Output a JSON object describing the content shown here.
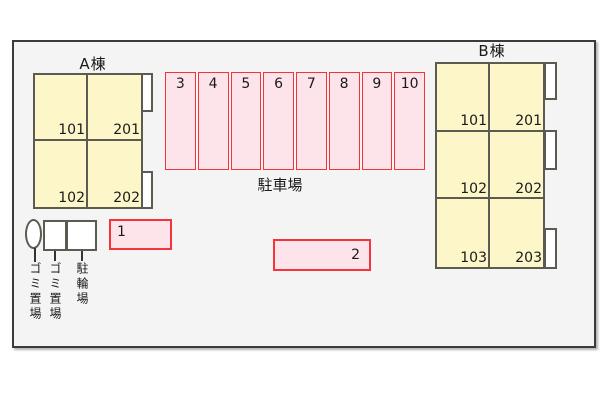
{
  "buildings": {
    "a": {
      "label": "A棟",
      "units": [
        [
          "101",
          "201"
        ],
        [
          "102",
          "202"
        ]
      ]
    },
    "b": {
      "label": "B棟",
      "units": [
        [
          "101",
          "201"
        ],
        [
          "102",
          "202"
        ],
        [
          "103",
          "203"
        ]
      ]
    }
  },
  "parking": {
    "label": "駐車場",
    "stalls": [
      "3",
      "4",
      "5",
      "6",
      "7",
      "8",
      "9",
      "10"
    ],
    "standalone_stalls": [
      "1",
      "2"
    ]
  },
  "facilities": {
    "garbage_area_1": "ゴミ置場",
    "garbage_area_2": "ゴミ置場",
    "bicycle_parking": "駐輪場"
  },
  "colors": {
    "building_fill": "#FCF6C8",
    "building_border": "#5B5B51",
    "parking_fill": "#FDE3EA",
    "parking_border": "#F5333B",
    "canvas_bg": "#F4F4F5",
    "outline": "#3B3B3B"
  }
}
